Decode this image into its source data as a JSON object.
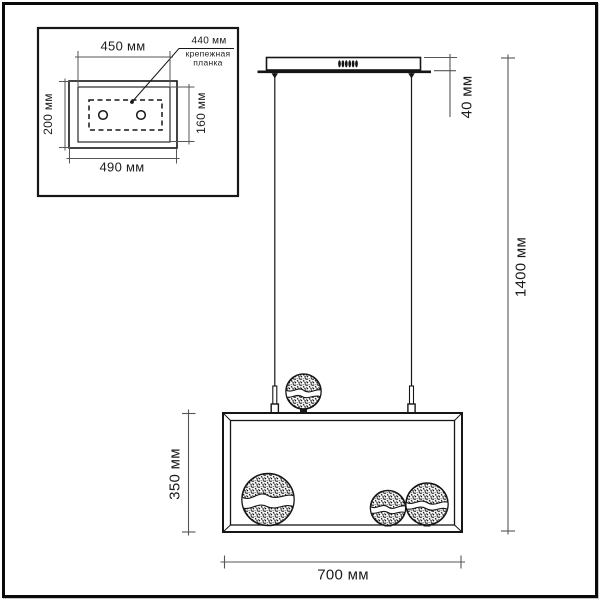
{
  "inset": {
    "inner_width": "450 мм",
    "bracket_width": "440 мм",
    "bracket_note": "крепежная планка",
    "outer_height": "200 мм",
    "inner_height": "160 мм",
    "outer_width": "490 мм"
  },
  "dimensions": {
    "canopy_height": "40 мм",
    "overall_height": "1400 мм",
    "shade_height": "350 мм",
    "shade_width": "700 мм"
  },
  "colors": {
    "object_line": "#161616",
    "dimension_line": "#565656",
    "background": "#ffffff"
  }
}
